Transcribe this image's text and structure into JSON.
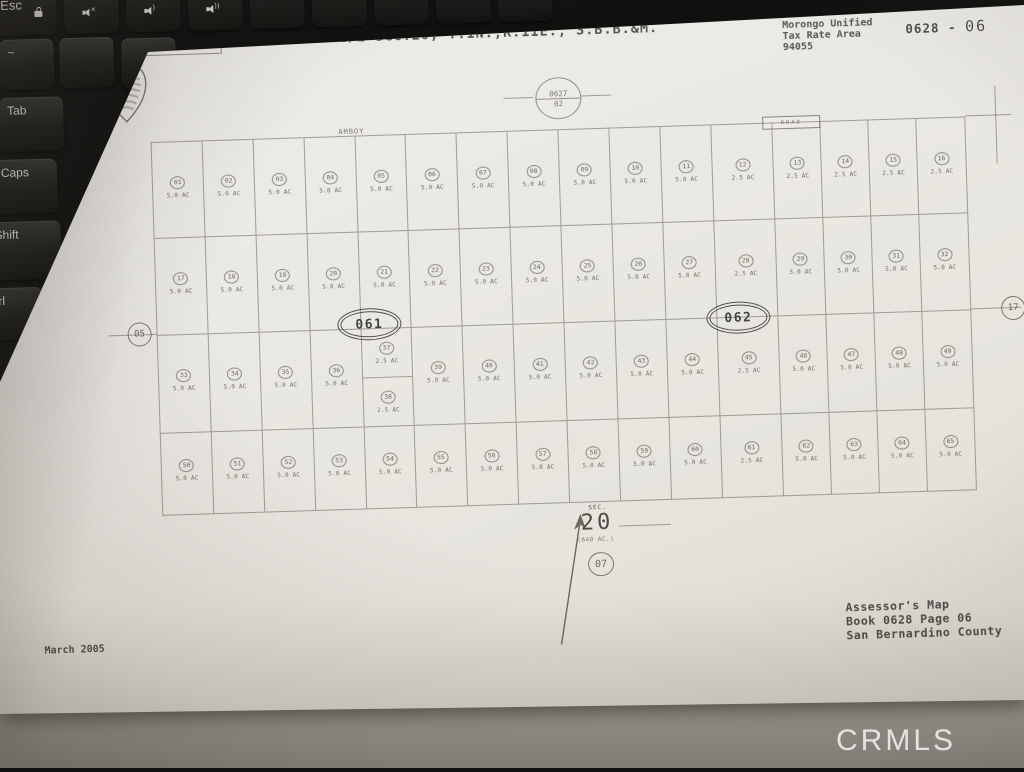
{
  "watermark": "CRMLS",
  "keyboard": {
    "top_keys": [
      {
        "name": "esc",
        "label": "Esc",
        "icon": "lock"
      },
      {
        "name": "f1",
        "label": "",
        "icon": "speaker-mute"
      },
      {
        "name": "f2",
        "label": "",
        "icon": "speaker-low"
      },
      {
        "name": "f3",
        "label": "",
        "icon": "speaker-high"
      },
      {
        "name": "f4",
        "label": "",
        "icon": "none"
      },
      {
        "name": "f5",
        "label": "",
        "icon": "none"
      },
      {
        "name": "f6",
        "label": "",
        "icon": "none"
      },
      {
        "name": "f7",
        "label": "",
        "icon": "none"
      },
      {
        "name": "f8",
        "label": "",
        "icon": "none"
      }
    ],
    "left_keys": [
      {
        "name": "tilde",
        "label": "~"
      },
      {
        "name": "tab",
        "label": "Tab"
      },
      {
        "name": "caps",
        "label": "Caps"
      },
      {
        "name": "shift",
        "label": "Shift"
      },
      {
        "name": "ctrl",
        "label": "Ctrl"
      }
    ]
  },
  "map": {
    "title": "N.1/2 Sec.20, T.1N.,R.11E., S.B.B.&M.",
    "stamp": {
      "line1": "THIS MAP IS FOR TAX PURPOSES",
      "line2": "OF NO VALIDITY (NOT FOR USE)"
    },
    "tax_area": {
      "line1": "Morongo Unified",
      "line2": "Tax Rate Area",
      "line3": "94055"
    },
    "page_code": {
      "book": "0628 -",
      "page": "06"
    },
    "adjacent_top": {
      "book": "0627",
      "page": "02"
    },
    "adjacent_left": "05",
    "adjacent_right": "17",
    "adjacent_bottom": "07",
    "road_top": "AMBOY",
    "road_box": "ROAD",
    "block_left": "061",
    "block_right": "062",
    "section": {
      "label": "SEC.",
      "number": "20",
      "acres": "(640 AC.)"
    },
    "footer": {
      "line1": "Assessor's Map",
      "line2": "Book 0628 Page 06",
      "line3": "San Bernardino County"
    },
    "date": "March 2005",
    "grid": {
      "rows": [
        {
          "cells": [
            {
              "n": "01",
              "ac": "5.0 AC"
            },
            {
              "n": "02",
              "ac": "5.0 AC"
            },
            {
              "n": "03",
              "ac": "5.0 AC"
            },
            {
              "n": "04",
              "ac": "5.0 AC"
            },
            {
              "n": "05",
              "ac": "5.0 AC"
            },
            {
              "n": "06",
              "ac": "5.0 AC"
            },
            {
              "n": "07",
              "ac": "5.0 AC"
            },
            {
              "n": "08",
              "ac": "5.0 AC"
            },
            {
              "n": "09",
              "ac": "5.0 AC"
            },
            {
              "n": "10",
              "ac": "5.0 AC"
            },
            {
              "n": "11",
              "ac": "5.0 AC"
            },
            {
              "n": "12",
              "ac": "2.5 AC"
            },
            {
              "n": "13",
              "ac": "2.5 AC"
            },
            {
              "n": "14",
              "ac": "2.5 AC"
            },
            {
              "n": "15",
              "ac": "2.5 AC"
            },
            {
              "n": "16",
              "ac": "2.5 AC"
            }
          ]
        },
        {
          "cells": [
            {
              "n": "17",
              "ac": "5.0 AC"
            },
            {
              "n": "18",
              "ac": "5.0 AC"
            },
            {
              "n": "19",
              "ac": "5.0 AC"
            },
            {
              "n": "20",
              "ac": "5.0 AC"
            },
            {
              "n": "21",
              "ac": "5.0 AC"
            },
            {
              "n": "22",
              "ac": "5.0 AC"
            },
            {
              "n": "23",
              "ac": "5.0 AC"
            },
            {
              "n": "24",
              "ac": "5.0 AC"
            },
            {
              "n": "25",
              "ac": "5.0 AC"
            },
            {
              "n": "26",
              "ac": "5.0 AC"
            },
            {
              "n": "27",
              "ac": "5.0 AC"
            },
            {
              "n": "28",
              "ac": "2.5 AC"
            },
            {
              "n": "29",
              "ac": "5.0 AC"
            },
            {
              "n": "30",
              "ac": "5.0 AC"
            },
            {
              "n": "31",
              "ac": "5.0 AC"
            },
            {
              "n": "32",
              "ac": "5.0 AC"
            }
          ]
        },
        {
          "cells": [
            {
              "n": "33",
              "ac": "5.0 AC"
            },
            {
              "n": "34",
              "ac": "5.0 AC"
            },
            {
              "n": "35",
              "ac": "5.0 AC"
            },
            {
              "n": "36",
              "ac": "5.0 AC"
            },
            {
              "split": [
                {
                  "n": "37",
                  "ac": "2.5 AC"
                },
                {
                  "n": "38",
                  "ac": "2.5 AC"
                }
              ]
            },
            {
              "n": "39",
              "ac": "5.0 AC"
            },
            {
              "n": "40",
              "ac": "5.0 AC"
            },
            {
              "n": "41",
              "ac": "5.0 AC"
            },
            {
              "n": "42",
              "ac": "5.0 AC"
            },
            {
              "n": "43",
              "ac": "5.0 AC"
            },
            {
              "n": "44",
              "ac": "5.0 AC"
            },
            {
              "n": "45",
              "ac": "2.5 AC"
            },
            {
              "n": "46",
              "ac": "5.0 AC"
            },
            {
              "n": "47",
              "ac": "5.0 AC"
            },
            {
              "n": "48",
              "ac": "5.0 AC"
            },
            {
              "n": "49",
              "ac": "5.0 AC"
            }
          ]
        },
        {
          "cells": [
            {
              "n": "50",
              "ac": "5.0 AC"
            },
            {
              "n": "51",
              "ac": "5.0 AC"
            },
            {
              "n": "52",
              "ac": "5.0 AC"
            },
            {
              "n": "53",
              "ac": "5.0 AC"
            },
            {
              "n": "54",
              "ac": "5.0 AC"
            },
            {
              "n": "55",
              "ac": "5.0 AC"
            },
            {
              "n": "56",
              "ac": "5.0 AC"
            },
            {
              "n": "57",
              "ac": "5.0 AC"
            },
            {
              "n": "58",
              "ac": "5.0 AC"
            },
            {
              "n": "59",
              "ac": "5.0 AC"
            },
            {
              "n": "60",
              "ac": "5.0 AC"
            },
            {
              "n": "61",
              "ac": "2.5 AC"
            },
            {
              "n": "62",
              "ac": "5.0 AC"
            },
            {
              "n": "63",
              "ac": "5.0 AC"
            },
            {
              "n": "64",
              "ac": "5.0 AC"
            },
            {
              "n": "65",
              "ac": "5.0 AC"
            }
          ]
        }
      ]
    }
  }
}
